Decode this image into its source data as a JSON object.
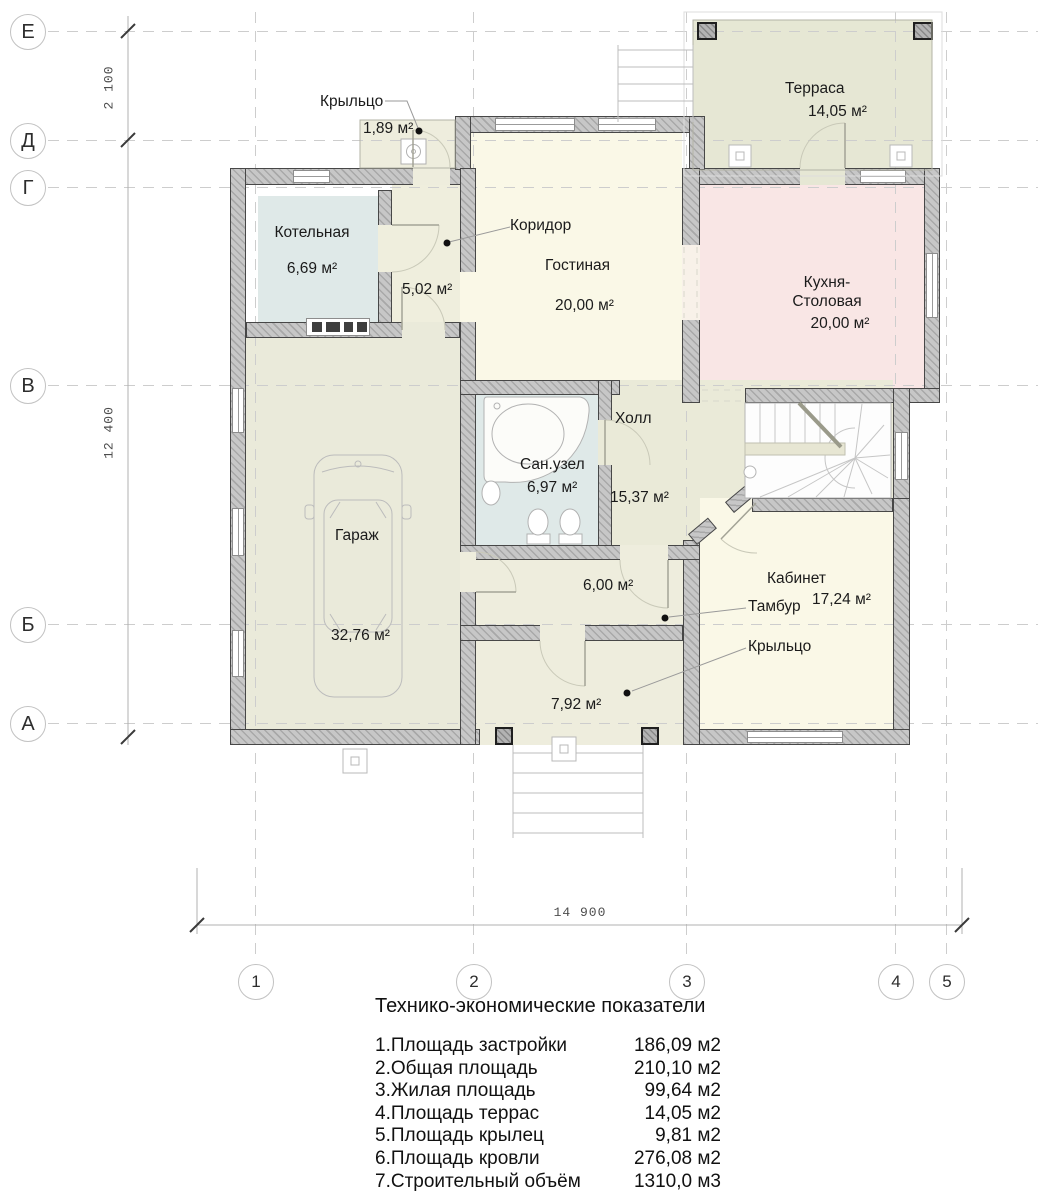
{
  "plan": {
    "rooms": {
      "porch_top": {
        "name": "Крыльцо",
        "area": "1,89 м²"
      },
      "boiler": {
        "name": "Котельная",
        "area": "6,69 м²"
      },
      "corridor": {
        "name": "Коридор",
        "area": "5,02 м²"
      },
      "living": {
        "name": "Гостиная",
        "area": "20,00 м²"
      },
      "terrace": {
        "name": "Терраса",
        "area": "14,05 м²"
      },
      "kitchen": {
        "name_line1": "Кухня-",
        "name_line2": "Столовая",
        "area": "20,00 м²"
      },
      "hall": {
        "name": "Холл",
        "area": "15,37 м²"
      },
      "bathroom": {
        "name": "Сан.узел",
        "area": "6,97 м²"
      },
      "garage": {
        "name": "Гараж",
        "area": "32,76 м²"
      },
      "cabinet": {
        "name": "Кабинет",
        "area": "17,24 м²"
      },
      "tambour": {
        "name": "Тамбур",
        "area": "6,00 м²"
      },
      "porch_bottom": {
        "name": "Крыльцо",
        "area": "7,92 м²"
      }
    },
    "axes": {
      "rows": [
        "Е",
        "Д",
        "Г",
        "В",
        "Б",
        "А"
      ],
      "cols": [
        "1",
        "2",
        "3",
        "4",
        "5"
      ]
    },
    "dimensions": {
      "top_left": "2 100",
      "left": "12 400",
      "bottom": "14 900"
    }
  },
  "table": {
    "title": "Технико-экономические показатели",
    "rows": [
      {
        "label": "1.Площадь застройки",
        "value": "186,09 м2"
      },
      {
        "label": "2.Общая площадь",
        "value": "210,10 м2"
      },
      {
        "label": "3.Жилая площадь",
        "value": "99,64 м2"
      },
      {
        "label": "4.Площадь террас",
        "value": "14,05 м2"
      },
      {
        "label": "5.Площадь крылец",
        "value": "9,81 м2"
      },
      {
        "label": "6.Площадь кровли",
        "value": "276,08 м2"
      },
      {
        "label": "7.Строительный объём",
        "value": "1310,0 м3"
      }
    ]
  }
}
